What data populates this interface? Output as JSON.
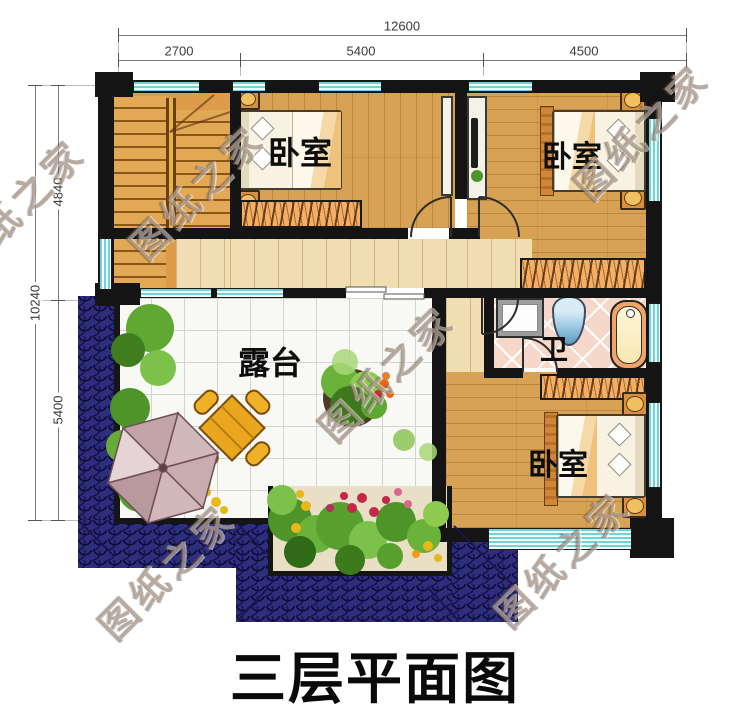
{
  "title": "三层平面图",
  "watermark": "图纸之家",
  "dimensions": {
    "top": {
      "total": "12600",
      "segments": [
        "2700",
        "5400",
        "4500"
      ]
    },
    "left": {
      "total": "10240",
      "segments": [
        "4840",
        "5400"
      ]
    }
  },
  "rooms": {
    "bedroom_top_left": "卧室",
    "bedroom_top_right": "卧室",
    "bedroom_bottom_right": "卧室",
    "bathroom": "卫",
    "terrace": "露台"
  },
  "colors": {
    "wall": "#141414",
    "wood_floor": "#d8a254",
    "wood_light": "#f0ddb2",
    "roof_tile_blue": "#2e2e7e",
    "window_glass": "#aee9e9",
    "bath_tile_pink": "#f6d8ca",
    "terrace_tile": "#f8f8f5",
    "wardrobe_orange": "#f5ae62",
    "umbrella_pink": "#cfb3b6",
    "table_yellow": "#eaa61e"
  }
}
